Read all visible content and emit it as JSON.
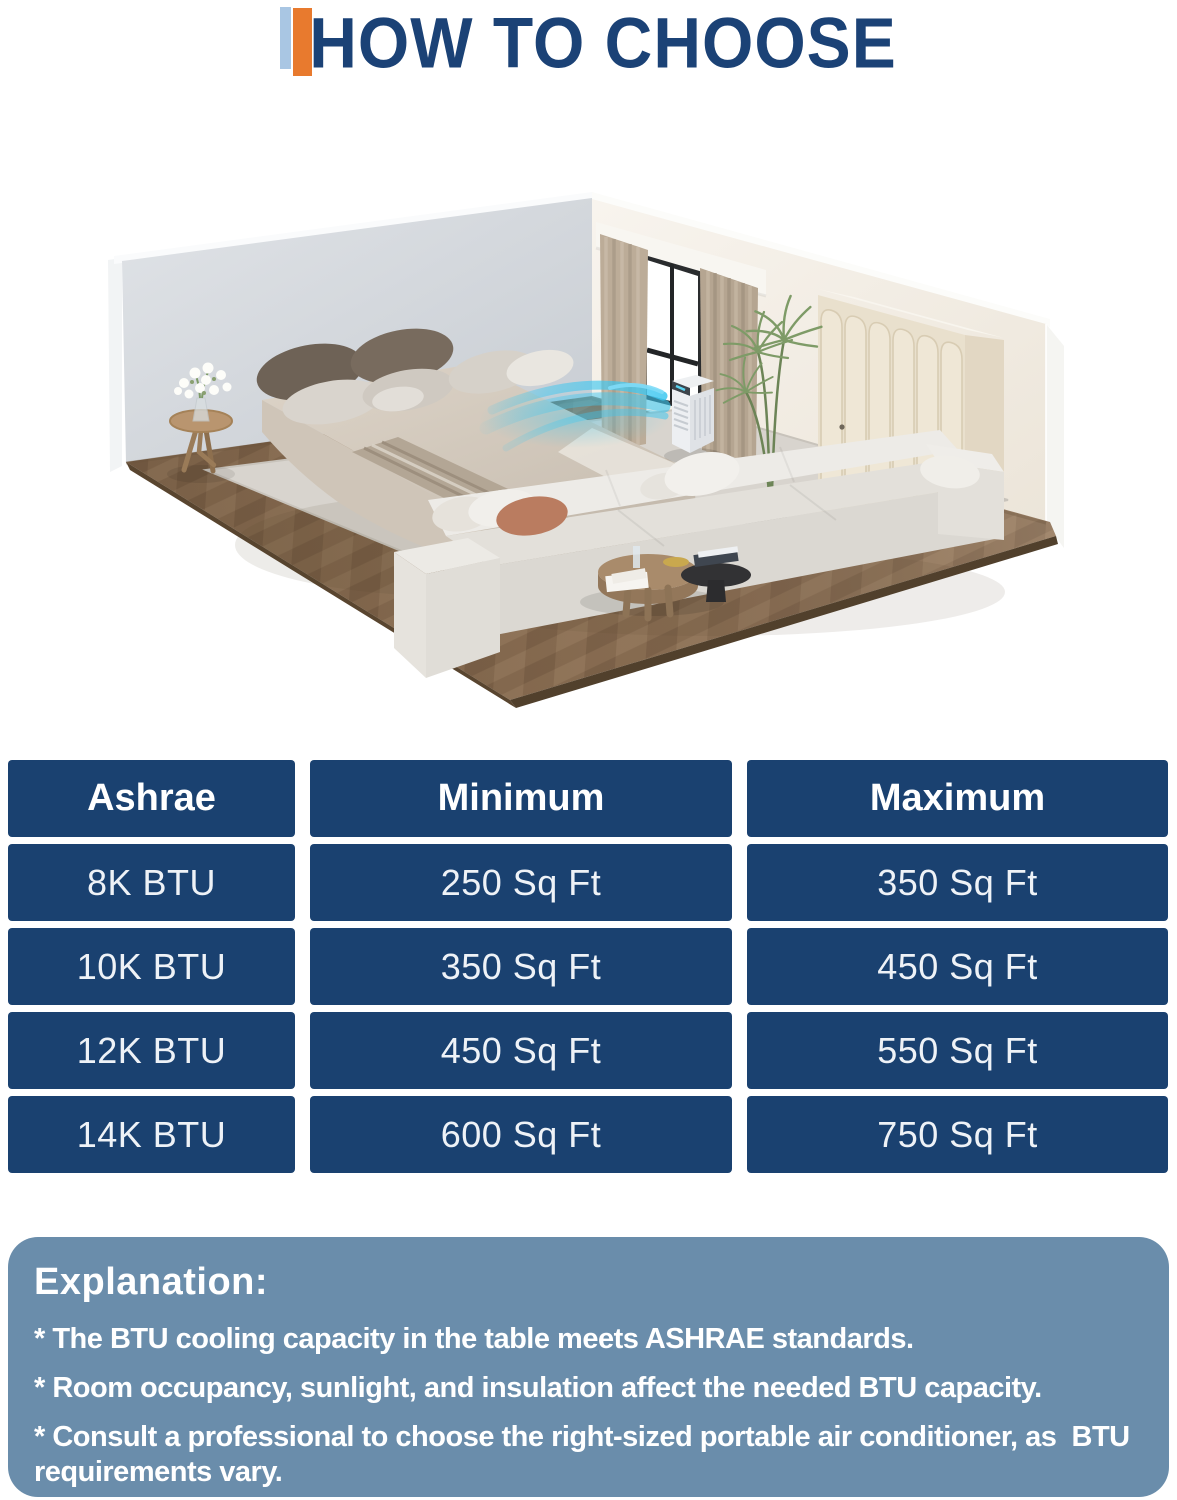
{
  "title": "HOW TO CHOOSE",
  "accent_colors": {
    "light_blue": "#a9c6e3",
    "orange": "#e87a2e",
    "navy": "#1b4276"
  },
  "table": {
    "cell_color": "#1a4170",
    "text_color": "#ffffff",
    "header": [
      "Ashrae",
      "Minimum",
      "Maximum"
    ],
    "rows": [
      [
        "8K BTU",
        "250 Sq Ft",
        "350 Sq Ft"
      ],
      [
        "10K BTU",
        "350 Sq Ft",
        "450 Sq Ft"
      ],
      [
        "12K BTU",
        "450 Sq Ft",
        "550 Sq Ft"
      ],
      [
        "14K BTU",
        "600 Sq Ft",
        "750 Sq Ft"
      ]
    ]
  },
  "explanation": {
    "background": "#6a8dab",
    "heading": "Explanation:",
    "bullets": [
      "* The BTU cooling capacity in the table meets ASHRAE standards.",
      "* Room occupancy, sunlight, and insulation affect the needed BTU capacity.",
      "* Consult a professional to choose the right-sized portable air conditioner, as  BTU requirements vary."
    ]
  },
  "illustration": {
    "description": "Isometric bedroom render with a portable air conditioner blowing cool air",
    "elements": [
      "wood-floor",
      "rug",
      "left-wall",
      "right-wall",
      "window",
      "curtains",
      "wardrobe",
      "bed",
      "pillows",
      "sofa",
      "coffee-table",
      "side-table",
      "flower-vase",
      "plant",
      "portable-air-conditioner",
      "cool-airflow"
    ]
  }
}
